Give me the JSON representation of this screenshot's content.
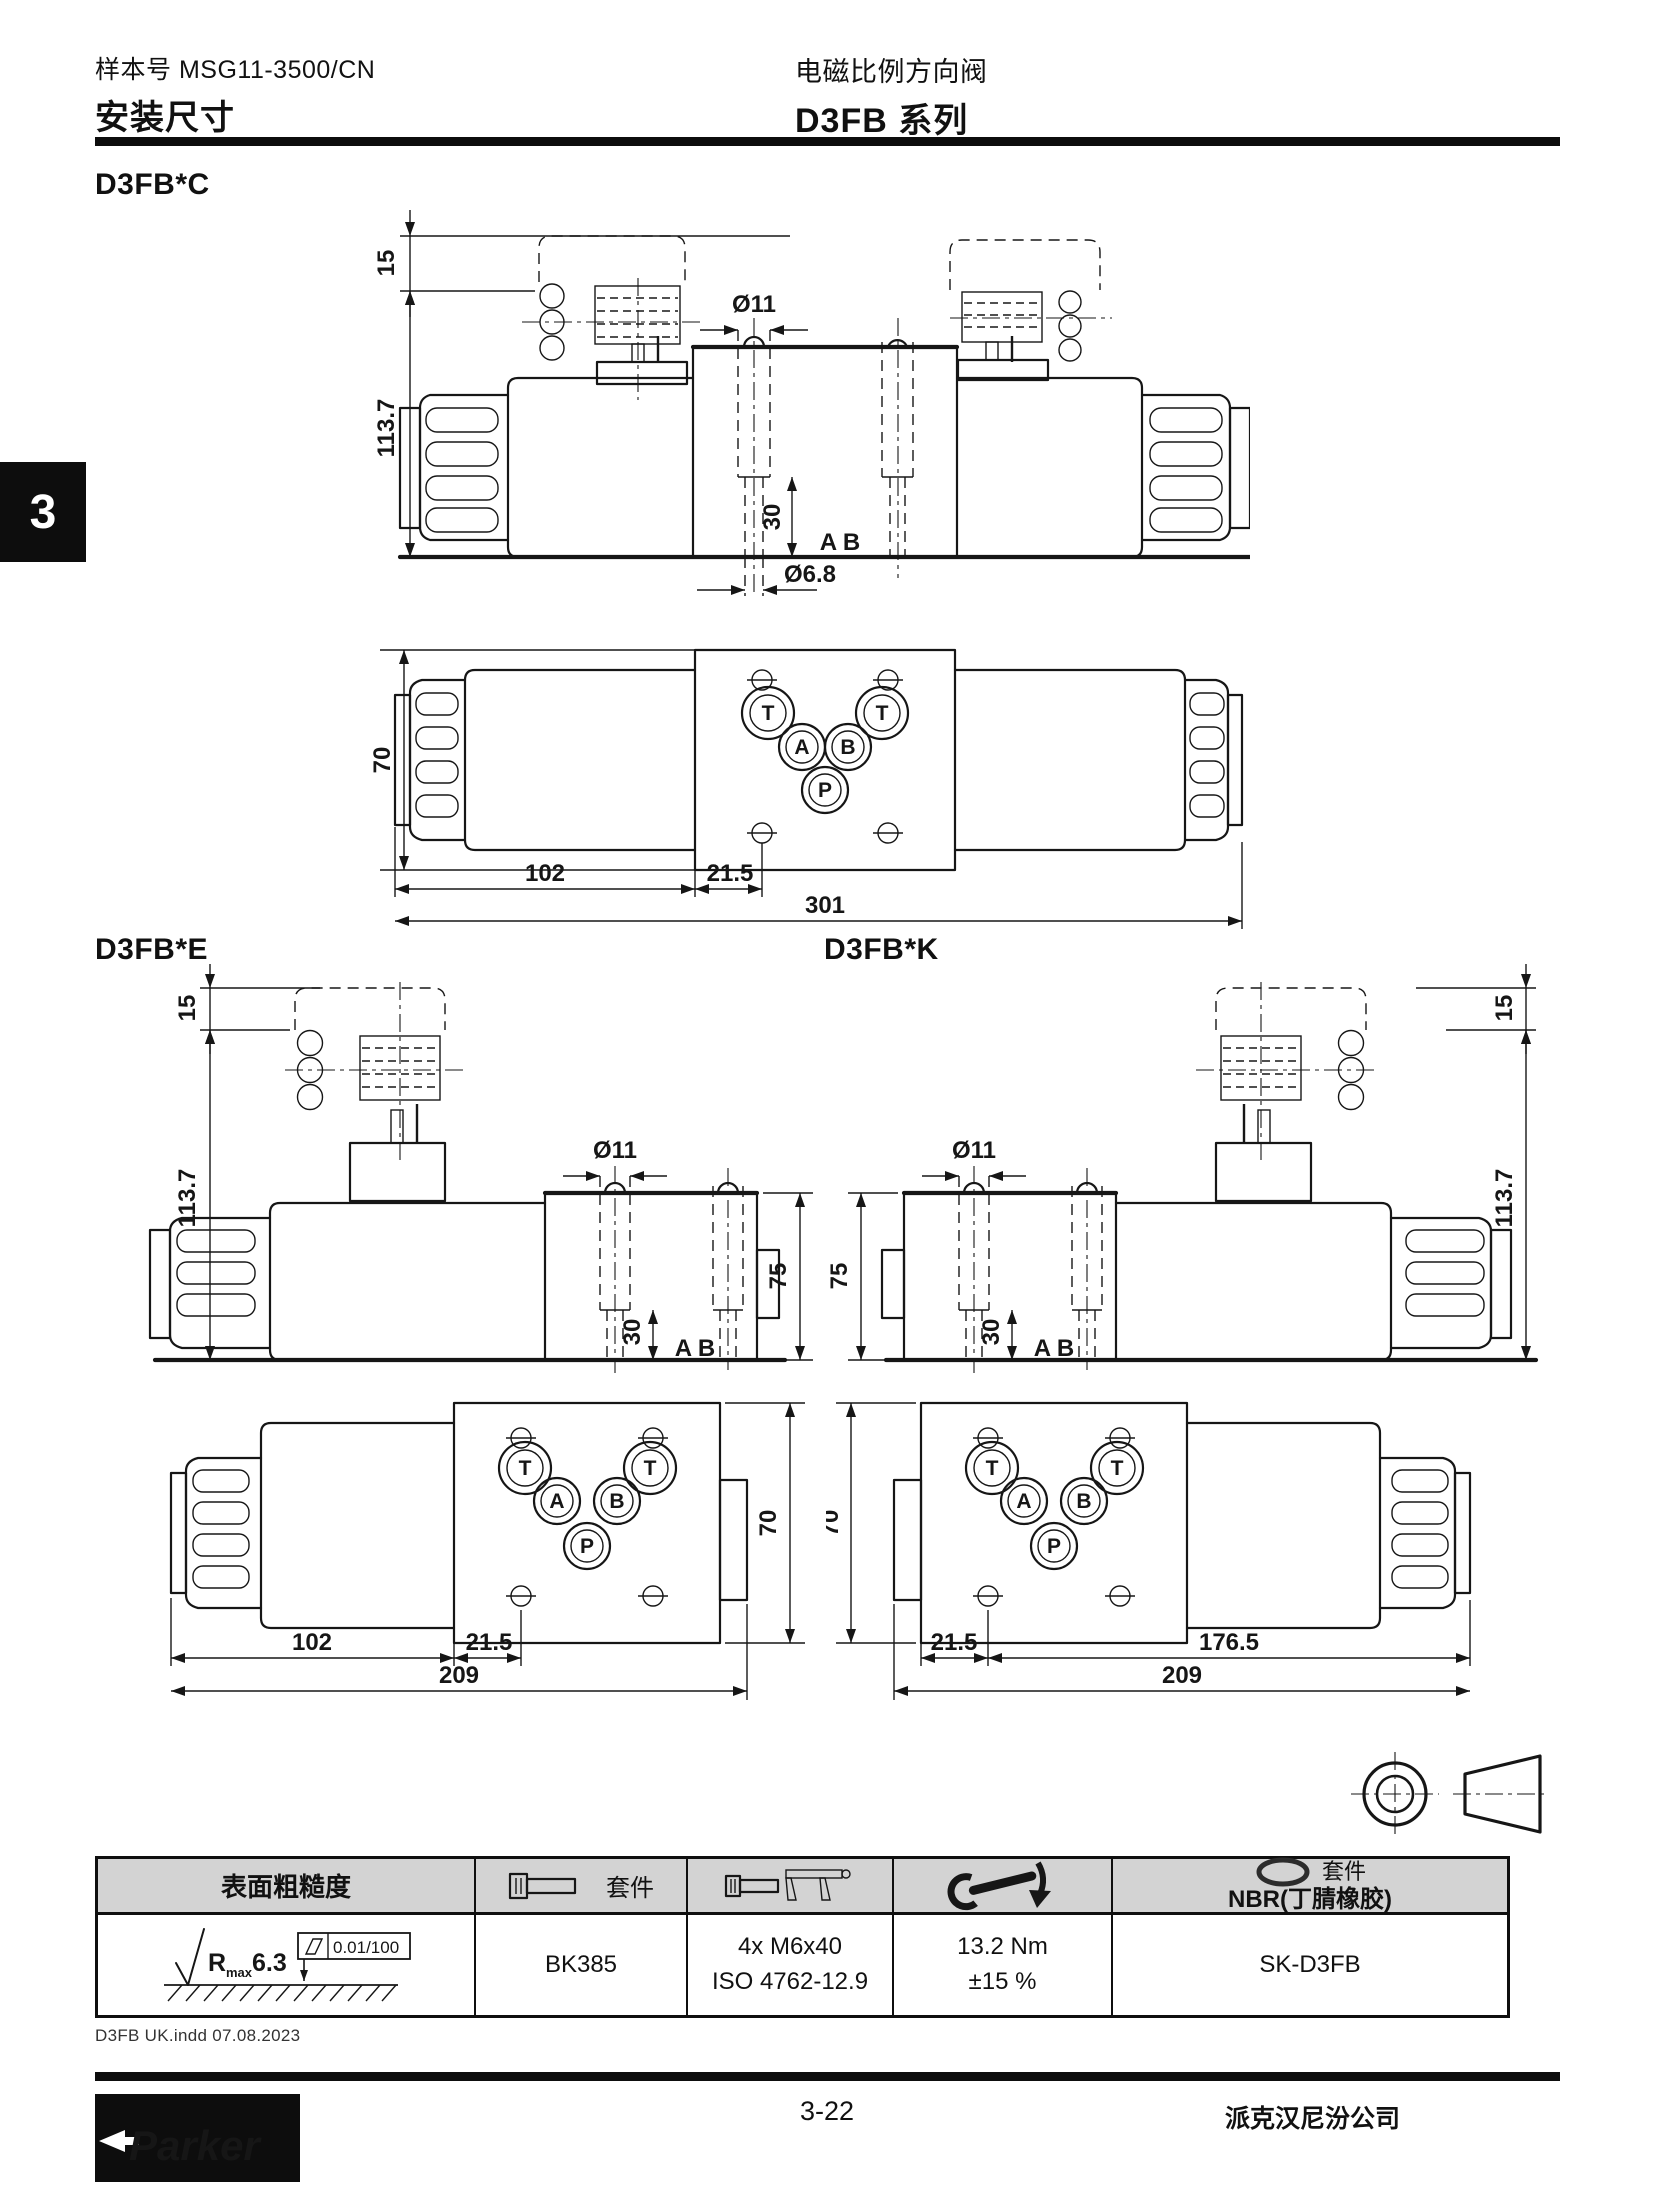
{
  "header": {
    "catalog_label": "样本号 MSG11-3500/CN",
    "title_left": "安装尺寸",
    "title_right_line1": "电磁比例方向阀",
    "title_right_line2": "D3FB 系列"
  },
  "side_tab": {
    "number": "3"
  },
  "sections": {
    "c": "D3FB*C",
    "e": "D3FB*E",
    "k": "D3FB*K"
  },
  "dims": {
    "d15": "15",
    "d113_7": "113.7",
    "dia11": "Ø11",
    "d30": "30",
    "ab": "A B",
    "dia6_8": "Ø6.8",
    "d70": "70",
    "d75": "75",
    "d102": "102",
    "d21_5": "21.5",
    "d301": "301",
    "d209": "209",
    "d176_5": "176.5"
  },
  "ports": {
    "t": "T",
    "a": "A",
    "b": "B",
    "p": "P"
  },
  "table": {
    "col1_header": "表面粗糙度",
    "col2_kit_label": "套件",
    "col5_kit_label": "套件",
    "col5_header_line2": "NBR(丁腈橡胶)",
    "roughness_r": "R",
    "roughness_sub": "max",
    "roughness_value": "6.3",
    "flatness": "0.01/100",
    "bolt_kit": "BK385",
    "screws_line1": "4x M6x40",
    "screws_line2": "ISO 4762-12.9",
    "torque_line1": "13.2 Nm",
    "torque_line2": "±15 %",
    "seal_kit": "SK-D3FB"
  },
  "footer": {
    "note": "D3FB UK.indd 07.08.2023",
    "page_number": "3-22",
    "company": "派克汉尼汾公司",
    "logo_text": "Parker"
  }
}
